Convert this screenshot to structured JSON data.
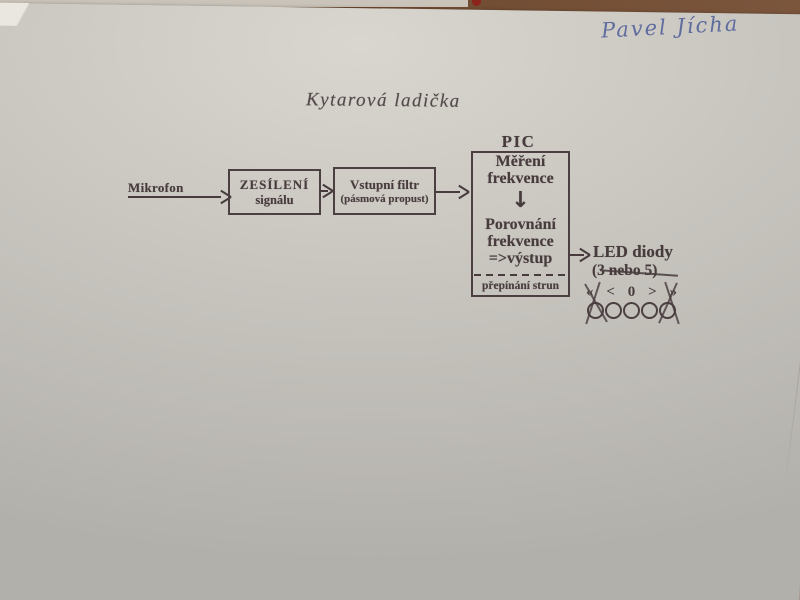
{
  "annotations": {
    "handwritten_name": "Pavel Jícha"
  },
  "diagram": {
    "title": "Kytarová ladička",
    "input_label": "Mikrofon",
    "amp_box": {
      "line1": "ZESÍLENÍ",
      "line2": "signálu"
    },
    "filter_box": {
      "line1": "Vstupní filtr",
      "line2": "(pásmová propust)"
    },
    "pic_block": {
      "label": "PIC",
      "measure_line1": "Měření",
      "measure_line2": "frekvence",
      "down_arrow_icon": "↓",
      "compare_line1": "Porovnání",
      "compare_line2": "frekvence",
      "output_line": "=>výstup",
      "footer": "přepínání strun"
    },
    "led_output": {
      "label": "LED diody",
      "count_prefix": "(3 ",
      "count_struck": "nebo 5",
      "count_suffix": ")",
      "symbols": [
        "«",
        "<",
        "0",
        ">",
        "»"
      ],
      "led_count": 5
    }
  },
  "colors": {
    "paper": "#c7c4be",
    "table": "#6e4a31",
    "ink": "#473b3d",
    "pen_blue": "#51609a",
    "red_mark": "#8c241c"
  }
}
